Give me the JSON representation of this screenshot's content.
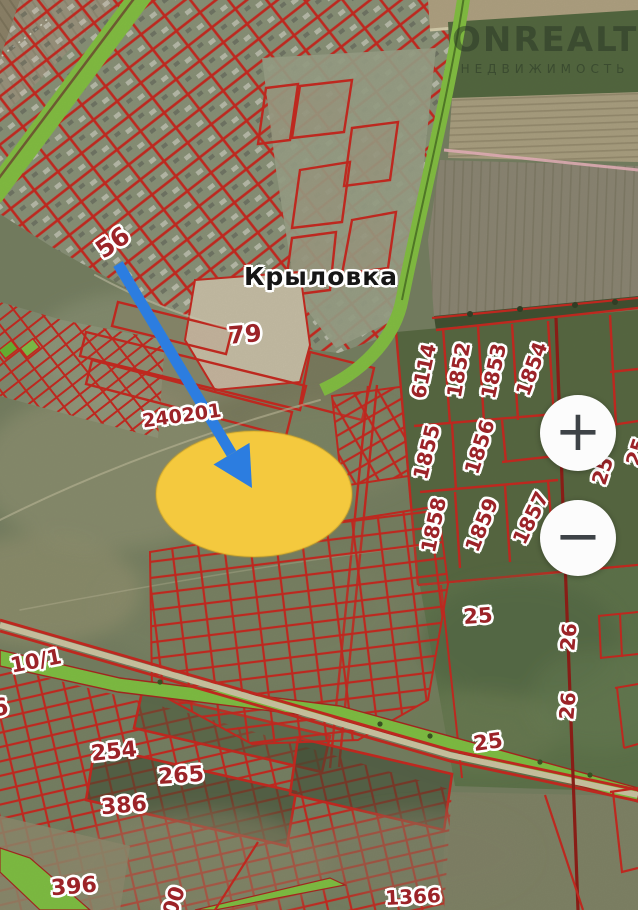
{
  "watermark": {
    "brand": "ONREALT",
    "subtitle": "НЕДВИЖИМОСТЬ"
  },
  "controls": {
    "zoom_in_label": "+",
    "zoom_out_label": "−"
  },
  "labels": [
    {
      "text": "56"
    },
    {
      "text": "Крыловка"
    },
    {
      "text": "79"
    },
    {
      "text": "240201"
    },
    {
      "text": "6114"
    },
    {
      "text": "1852"
    },
    {
      "text": "1853"
    },
    {
      "text": "1854"
    },
    {
      "text": "1855"
    },
    {
      "text": "1856"
    },
    {
      "text": "1857"
    },
    {
      "text": "1858"
    },
    {
      "text": "1859"
    },
    {
      "text": "25"
    },
    {
      "text": "25"
    },
    {
      "text": "25"
    },
    {
      "text": "26"
    },
    {
      "text": "26"
    },
    {
      "text": "25"
    },
    {
      "text": "10/1"
    },
    {
      "text": "6"
    },
    {
      "text": "254"
    },
    {
      "text": "265"
    },
    {
      "text": "386"
    },
    {
      "text": "396"
    },
    {
      "text": "1366"
    },
    {
      "text": "00"
    }
  ],
  "colors": {
    "parcel_outline_red": "#c9231a",
    "label_red": "#9c2328",
    "place_label_black": "#161616",
    "highlight_yellow": "#f4c93e",
    "arrow_blue": "#2c7de0",
    "greenway_green": "#7ec23f",
    "watermark_tint": "#2a3a28"
  }
}
